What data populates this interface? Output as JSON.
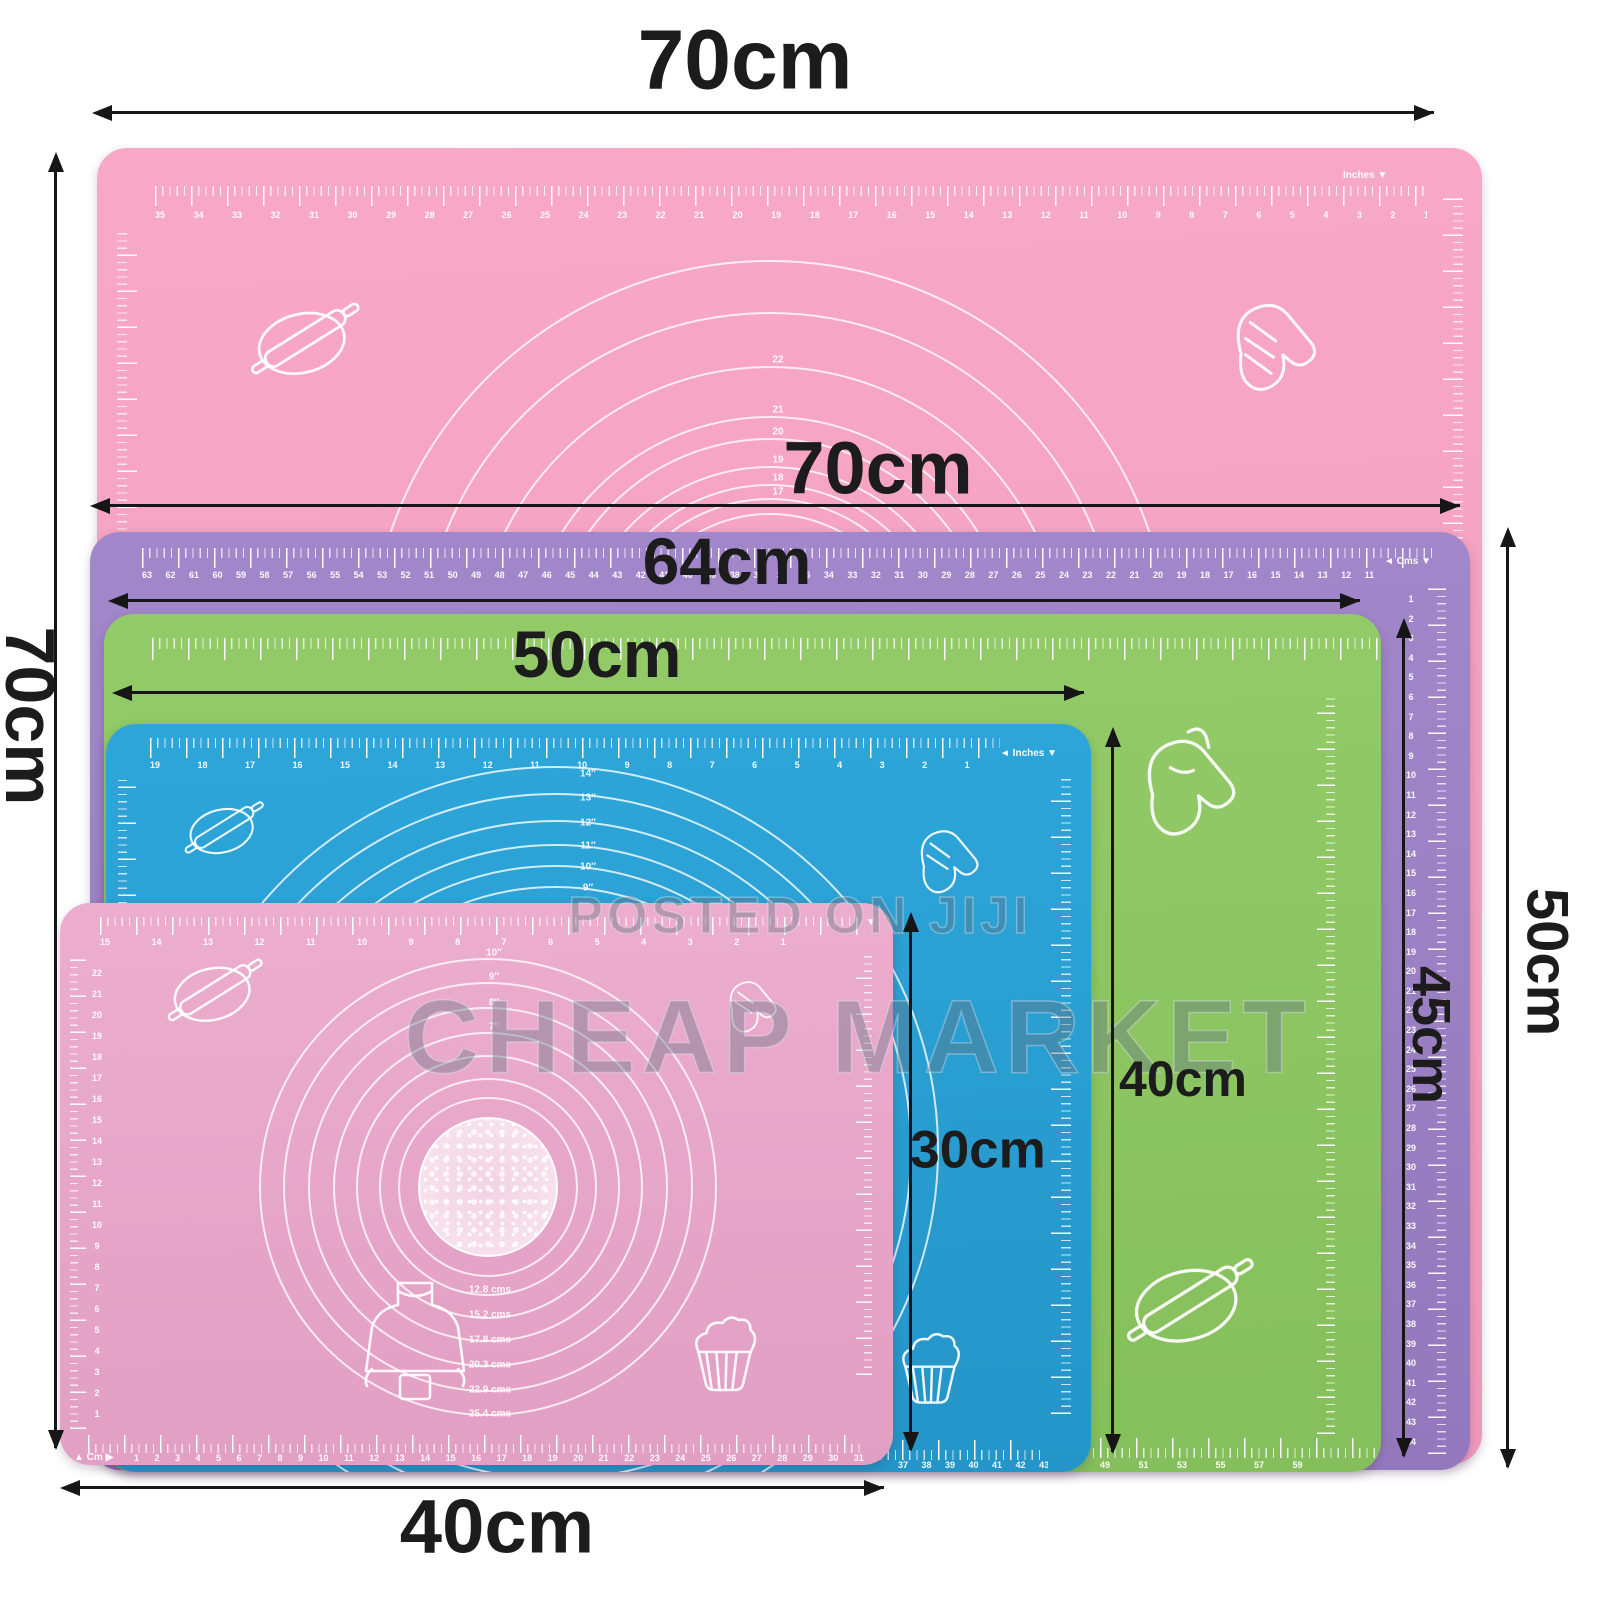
{
  "watermark": {
    "line1": "POSTED ON JIJI",
    "line2": "CHEAP MARKET"
  },
  "arrow_color": "#161616",
  "mats": {
    "pink70": {
      "name": "pink pastry mat 70x70cm",
      "color": "#f5a3c3",
      "width_label": "70cm",
      "height_label": "70cm",
      "unit_marker": "Inches ▼",
      "top_numbers": "35 34 33 32 31 30 29 28 27 26 25 24 23 22 21 20 19 18 17 16 15 14 13 12 11 10 9 8 7 6 5 4 3 2 1",
      "ring_labels": [
        "22",
        "21",
        "20",
        "19",
        "18",
        "17"
      ]
    },
    "purple70x50": {
      "name": "purple pastry mat 70x50cm",
      "color": "#9d81c6",
      "width_label": "70cm",
      "height_label": "50cm",
      "unit_marker": "◄ Cms ▼",
      "top_numbers": "63 62 61 60 59 58 57 56 55 54 53 52 51 50 49 48 47 46 45 44 43 42 41 40 39 38 37 36 35 34 33 32 31 30 29 28 27 26 25 24 23 22 21 20 19 18 17 16 15 14 13 12 11 10 9 8 7 6 5 4 3 2 1",
      "right_numbers": "1\n2\n3\n4\n5\n6\n7\n8\n9\n10\n11\n12\n13\n14\n15\n16\n17\n18\n19\n20\n21\n22\n23\n24\n25\n26\n27\n28\n29\n30\n31\n32\n33\n34\n35\n36\n37\n38\n39\n40\n41\n42\n43\n44"
    },
    "green64x45": {
      "name": "green pastry mat 64x45cm",
      "color": "#8ec765",
      "width_label": "64cm",
      "height_label": "45cm",
      "bottom_numbers": "49 51 53 55 57 59"
    },
    "blue50x40": {
      "name": "blue pastry mat 50x40cm",
      "color": "#2da2d7",
      "width_label": "50cm",
      "height_label": "40cm",
      "unit_marker": "◄ Inches ▼",
      "top_numbers": "19 18 17 16 15 14 13 12 11 10 9 8 7 6 5 4 3 2 1",
      "bottom_numbers": "37 38 39 40 41 42 43",
      "ring_labels": [
        "14″",
        "13″",
        "12″",
        "11″",
        "10″",
        "9″"
      ]
    },
    "pink40x30": {
      "name": "pink pastry mat 40x30cm",
      "color": "#e9aacb",
      "width_label": "40cm",
      "height_label": "30cm",
      "unit_marker_bottom": "▲ Cm ▶",
      "unit_marker_right": "▼",
      "top_numbers": "15 14 13 12 11 10 9 8 7 6 5 4 3 2 1",
      "bottom_numbers": "1 2 3 4 5 6 7 8 9 10 11 12 13 14 15 16 17 18 19 20 21 22 23 24 25 26 27 28 29 30 31 32 33 34",
      "left_numbers": "22\n21\n20\n19\n18\n17\n16\n15\n14\n13\n12\n11\n10\n9\n8\n7\n6\n5\n4\n3\n2\n1",
      "ring_labels_top": [
        "10″",
        "9″",
        "8″",
        "7″"
      ],
      "ring_labels_bottom": [
        "12.8 cms",
        "15.2 cms",
        "17.8 cms",
        "20.3 cms",
        "22.9 cms",
        "25.4 cms"
      ]
    }
  }
}
